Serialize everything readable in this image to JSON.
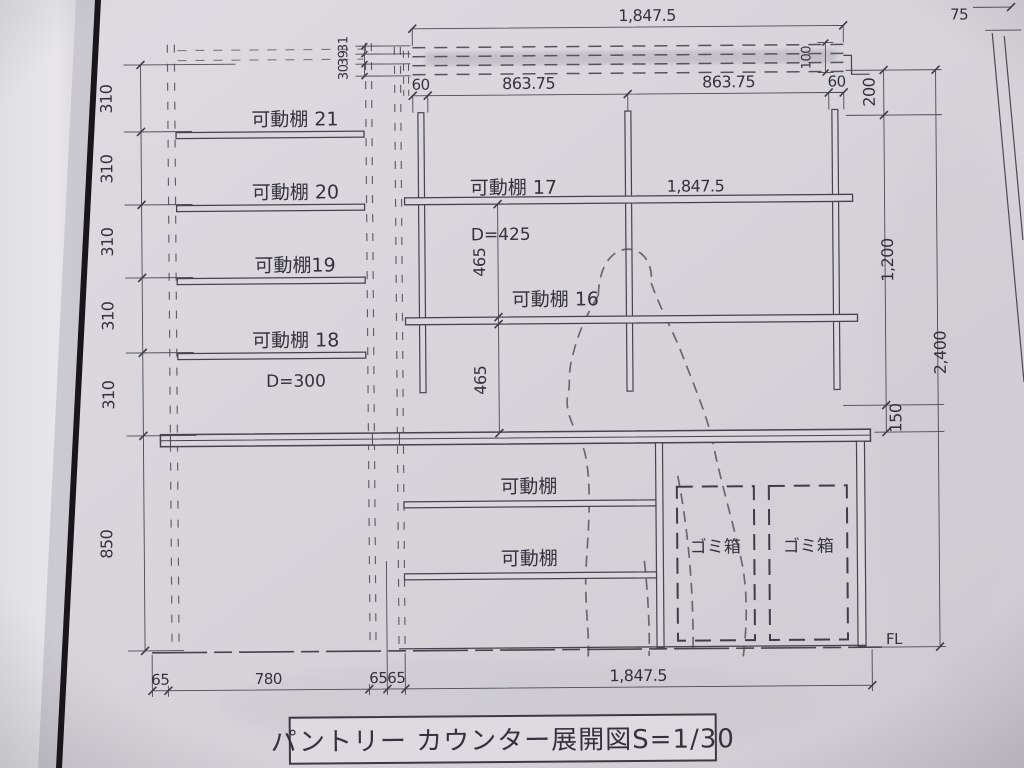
{
  "sheet": {
    "title": "パントリー カウンター展開図S=1/30",
    "floor_label": "FL",
    "corner_dim": "75"
  },
  "left_cabinet": {
    "shelves": [
      "可動棚 21",
      "可動棚 20",
      "可動棚19",
      "可動棚 18"
    ],
    "depth": "D=300",
    "pitch_dims": [
      "310",
      "310",
      "310",
      "310",
      "310"
    ],
    "base_height": "850",
    "bottom_dims": [
      "65",
      "780",
      "65",
      "65"
    ]
  },
  "upper_cabinet": {
    "overall_width": "1,847.5",
    "band_rows": [
      "31",
      "39",
      "30"
    ],
    "band_height": "100",
    "bay_dims": [
      "60",
      "863.75",
      "863.75",
      "60"
    ],
    "shelf17": "可動棚 17",
    "shelf17_width": "1,847.5",
    "depth": "D=425",
    "gap_dims": [
      "465",
      "465"
    ],
    "shelf16": "可動棚 16",
    "right_dims": [
      "200",
      "1,200",
      "150"
    ],
    "overall_height": "2,400"
  },
  "base_cabinet": {
    "shelves": [
      "可動棚",
      "可動棚"
    ],
    "bins": [
      "ゴミ箱",
      "ゴミ箱"
    ],
    "overall_width": "1,847.5"
  },
  "colors": {
    "line": "#45444e",
    "paper": "#d8d5db",
    "page_edge": "#18161b"
  }
}
